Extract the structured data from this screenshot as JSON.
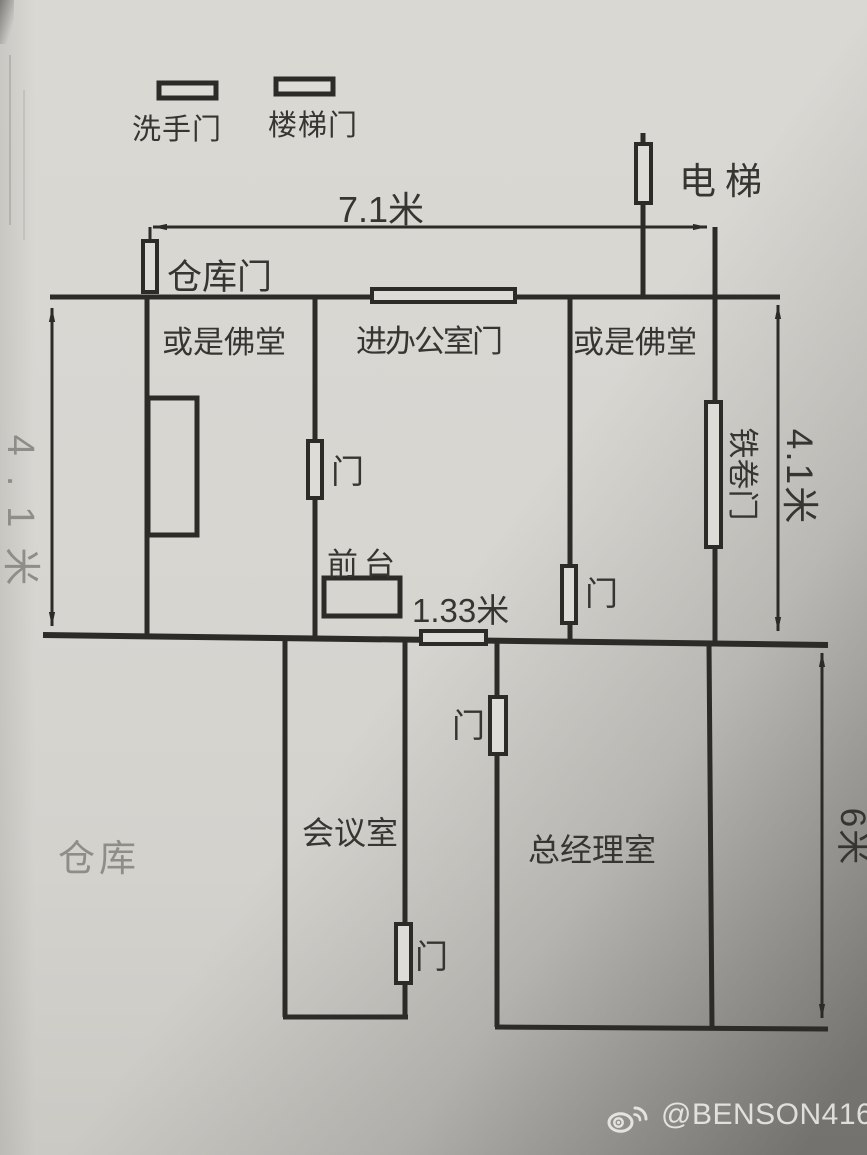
{
  "legend": {
    "washroom_door": "洗手门",
    "stair_door": "楼梯门"
  },
  "labels": {
    "elevator": "电梯",
    "warehouse_door": "仓库门",
    "room_left": "或是佛堂",
    "office_entry_door": "进办公室门",
    "room_right": "或是佛堂",
    "rolling_shutter_door": "铁卷门",
    "front_desk": "前台",
    "meeting_room": "会议室",
    "general_manager_office": "总经理室",
    "warehouse": "仓库",
    "door": "门"
  },
  "dimensions": {
    "top_width": "7.1米",
    "left_height": "4.1米",
    "right_height": "4.1米",
    "corridor_width": "1.33米",
    "bottom_height": "6米"
  },
  "watermark": {
    "handle": "@BENSON41661",
    "icon": "weibo-icon"
  },
  "colors": {
    "ink": "#2c2b28",
    "paper": "#d8d6d1",
    "door_fill": "#dedcd7",
    "pencil_gray": "#8f8d87",
    "watermark_text": "#f6f5f2"
  }
}
